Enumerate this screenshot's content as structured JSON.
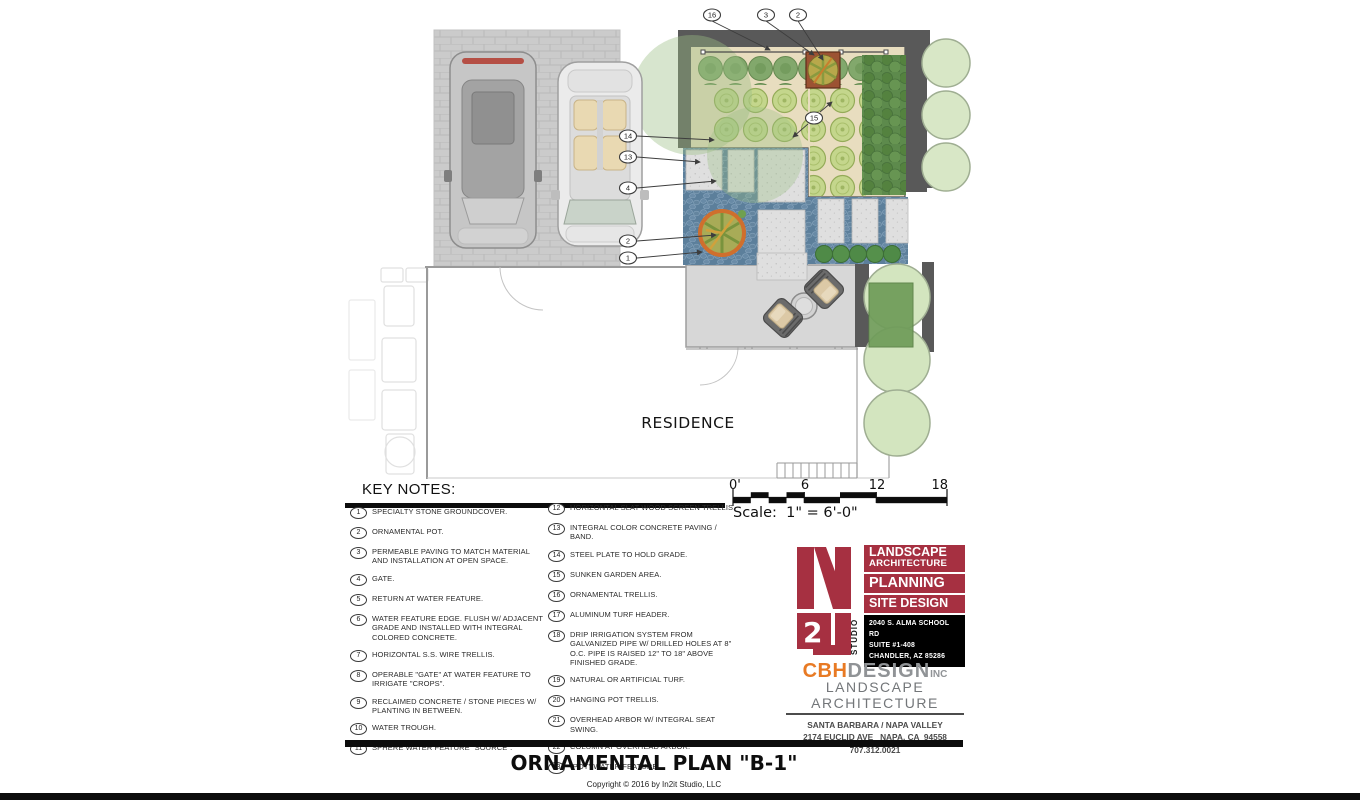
{
  "plan": {
    "residence_label": "RESIDENCE",
    "callouts": {
      "c16": "16",
      "c3": "3",
      "c2_top": "2",
      "c15": "15",
      "c14": "14",
      "c13": "13",
      "c4": "4",
      "c2_left": "2",
      "c1": "1"
    }
  },
  "scale_bar": {
    "ticks": [
      "0'",
      "6",
      "12",
      "18"
    ],
    "label": "Scale:  1\" = 6'-0\""
  },
  "key_notes": {
    "title": "KEY NOTES:",
    "left": [
      {
        "num": "1",
        "text": "SPECIALTY STONE GROUNDCOVER."
      },
      {
        "num": "2",
        "text": "ORNAMENTAL POT."
      },
      {
        "num": "3",
        "text": "PERMEABLE PAVING TO MATCH MATERIAL AND INSTALLATION AT OPEN SPACE."
      },
      {
        "num": "4",
        "text": "GATE."
      },
      {
        "num": "5",
        "text": "RETURN AT WATER FEATURE."
      },
      {
        "num": "6",
        "text": "WATER FEATURE EDGE. FLUSH W/ ADJACENT GRADE AND INSTALLED WITH INTEGRAL COLORED CONCRETE."
      },
      {
        "num": "7",
        "text": "HORIZONTAL S.S. WIRE TRELLIS."
      },
      {
        "num": "8",
        "text": "OPERABLE \"GATE\" AT WATER FEATURE TO IRRIGATE \"CROPS\"."
      },
      {
        "num": "9",
        "text": "RECLAIMED CONCRETE / STONE PIECES W/ PLANTING IN BETWEEN."
      },
      {
        "num": "10",
        "text": "WATER TROUGH."
      },
      {
        "num": "11",
        "text": "SPHERE WATER FEATURE \"SOURCE\"."
      }
    ],
    "right": [
      {
        "num": "12",
        "text": "HORIZONTAL SLAT WOOD SCREEN TRELLIS."
      },
      {
        "num": "13",
        "text": "INTEGRAL COLOR CONCRETE PAVING / BAND."
      },
      {
        "num": "14",
        "text": "STEEL PLATE TO HOLD GRADE."
      },
      {
        "num": "15",
        "text": "SUNKEN GARDEN AREA."
      },
      {
        "num": "16",
        "text": "ORNAMENTAL TRELLIS."
      },
      {
        "num": "17",
        "text": "ALUMINUM TURF HEADER."
      },
      {
        "num": "18",
        "text": "DRIP IRRIGATION SYSTEM FROM GALVANIZED PIPE W/ DRILLED HOLES AT 8\" O.C. PIPE IS RAISED 12\" TO 18\" ABOVE FINISHED GRADE."
      },
      {
        "num": "19",
        "text": "NATURAL OR ARTIFICIAL TURF."
      },
      {
        "num": "20",
        "text": "HANGING POT TRELLIS."
      },
      {
        "num": "21",
        "text": "OVERHEAD ARBOR W/ INTEGRAL SEAT SWING."
      },
      {
        "num": "22",
        "text": "COLUMN AT OVERHEAD ARBOR."
      },
      {
        "num": "23",
        "text": "\"POT\" WATER FEATURE."
      }
    ]
  },
  "in2it_logo": {
    "monogram_number": "2",
    "studio_vertical": "STUDIO",
    "services": [
      "LANDSCAPE",
      "ARCHITECTURE",
      "PLANNING",
      "SITE DESIGN"
    ],
    "address_lines": [
      "2040 S. ALMA SCHOOL RD",
      "SUITE #1-408",
      "CHANDLER, AZ 85286"
    ]
  },
  "cbh_logo": {
    "name_primary": "CBH",
    "name_secondary": "DESIGN",
    "name_suffix": "INC",
    "tagline": "LANDSCAPE ARCHITECTURE",
    "address_lines": [
      "SANTA BARBARA / NAPA VALLEY",
      "2174 EUCLID AVE   NAPA, CA  94558",
      "707.312.0021"
    ]
  },
  "footer": {
    "title": "ORNAMENTAL PLAN \"B-1\"",
    "copyright": "Copyright © 2016 by In2it Studio, LLC"
  },
  "colors": {
    "accent_red": "#a63041",
    "accent_orange": "#e87a24",
    "stone_blue": "#5c7f9b",
    "bed_tan": "#e8ddbf",
    "wall_gray": "#595959"
  }
}
